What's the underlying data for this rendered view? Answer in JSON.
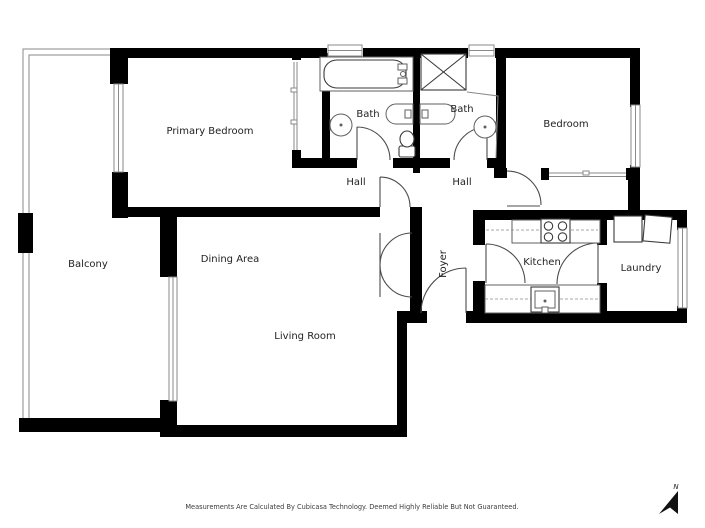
{
  "rooms": {
    "primary_bedroom": "Primary Bedroom",
    "bath_left": "Bath",
    "bath_right": "Bath",
    "bedroom": "Bedroom",
    "hall_left": "Hall",
    "hall_right": "Hall",
    "balcony": "Balcony",
    "dining_area": "Dining Area",
    "foyer": "Foyer",
    "kitchen": "Kitchen",
    "laundry": "Laundry",
    "living_room": "Living Room"
  },
  "footer": {
    "disclaimer": "Measurements Are Calculated By Cubicasa Technology. Deemed Highly Reliable But Not Guaranteed."
  },
  "compass": {
    "label": "N"
  },
  "colors": {
    "walls": "#000000",
    "background": "#ffffff",
    "thin_lines": "#8a8a8a",
    "text": "#1f1f1f"
  }
}
